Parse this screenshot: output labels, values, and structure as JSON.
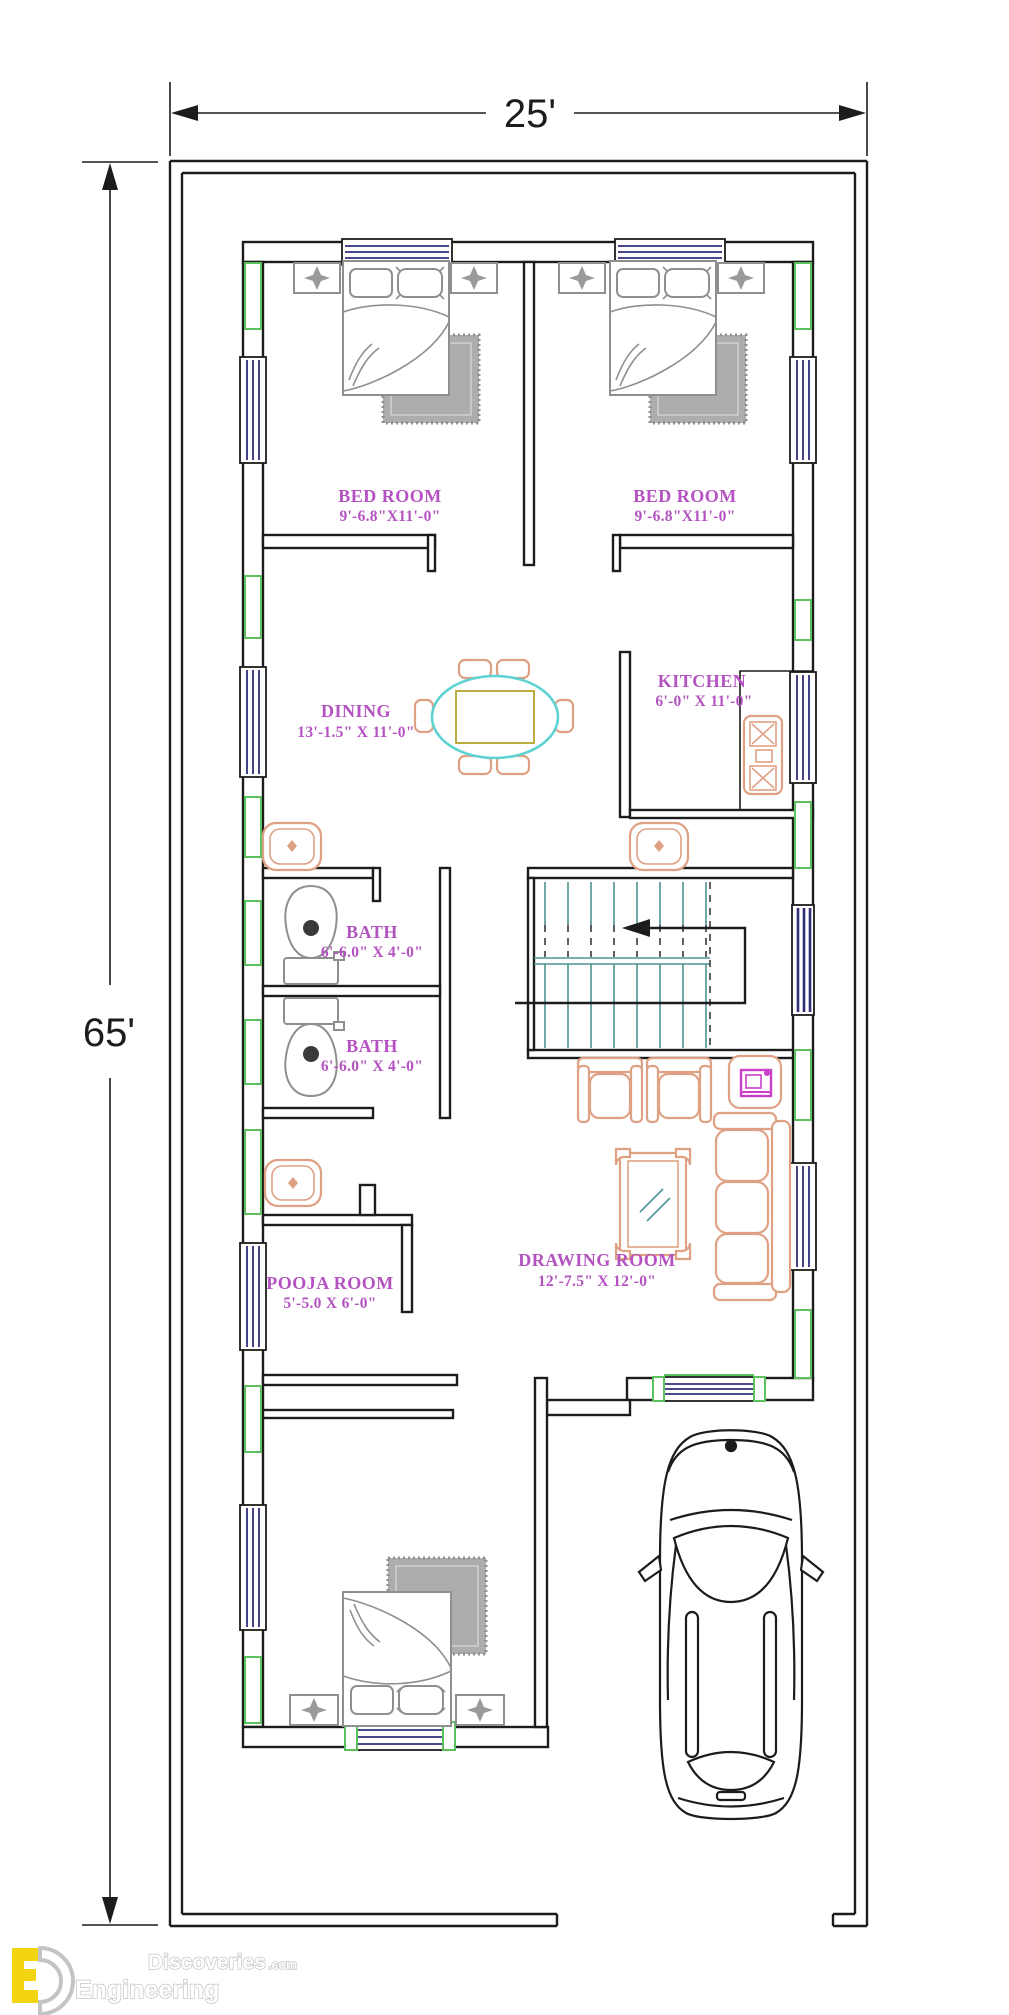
{
  "plan": {
    "type": "floor-plan",
    "plot_width_label": "25'",
    "plot_height_label": "65'"
  },
  "rooms": [
    {
      "id": "bedroom-1",
      "name": "BED ROOM",
      "size": "9'-6.8\"X11'-0\""
    },
    {
      "id": "bedroom-2",
      "name": "BED ROOM",
      "size": "9'-6.8\"X11'-0\""
    },
    {
      "id": "dining",
      "name": "DINING",
      "size": "13'-1.5\" X 11'-0\""
    },
    {
      "id": "kitchen",
      "name": "KITCHEN",
      "size": "6'-0\" X 11'-0\""
    },
    {
      "id": "bath-1",
      "name": "BATH",
      "size": "6'-6.0\" X 4'-0\""
    },
    {
      "id": "bath-2",
      "name": "BATH",
      "size": "6'-6.0\" X 4'-0\""
    },
    {
      "id": "pooja-room",
      "name": "POOJA ROOM",
      "size": "5'-5.0 X 6'-0\""
    },
    {
      "id": "drawing-room",
      "name": "DRAWING ROOM",
      "size": "12'-7.5\" X 12'-0\""
    }
  ],
  "symbols": [
    "double-bed",
    "double-bed",
    "single-bed-bottom",
    "dining-table-6-seat",
    "gas-stove",
    "wash-basin",
    "wash-basin",
    "wash-basin",
    "toilet",
    "toilet",
    "staircase-up-arrow",
    "two-seater-chairs",
    "tv-unit",
    "three-seater-sofa",
    "center-table",
    "car-top-view"
  ],
  "logo": {
    "monogram_e": "E",
    "monogram_d": "D",
    "word_top": "Discoveries",
    "word_top_suffix": ".com",
    "word_bottom": "Engineering"
  },
  "colors": {
    "wall_black": "#1c1c1c",
    "label_magenta": "#b352c0",
    "furniture_grey": "#8f8f8f",
    "rug_grey": "#adadad",
    "column_green": "#5cc05c",
    "window_blue": "#2e2e7a",
    "furniture_salmon": "#dfa183",
    "dining_table_cyan": "#5fd3d3",
    "dining_table_yellow": "#b5a32e",
    "stairs_teal": "#4d9393",
    "tv_magenta": "#c93fc9",
    "logo_yellow": "#f2d410",
    "logo_grey": "#c4c4c4"
  }
}
